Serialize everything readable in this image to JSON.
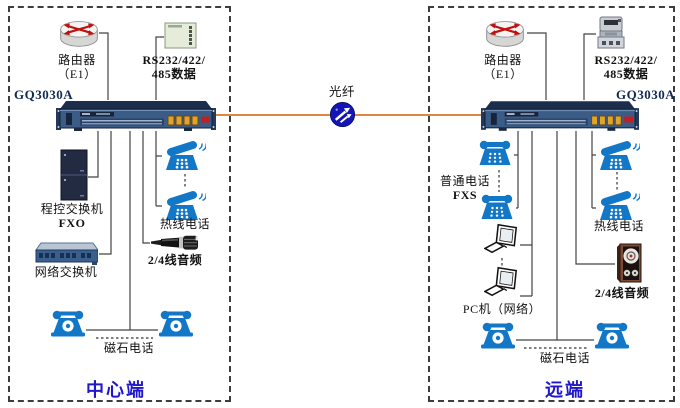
{
  "fiber": {
    "label": "光纤"
  },
  "left_site": {
    "title": "中心端",
    "terminal_label": "GQ3030A",
    "router": {
      "line1": "路由器",
      "line2": "（E1）"
    },
    "serial_data": {
      "line1": "RS232/422/",
      "line2": "485数据"
    },
    "pbx": {
      "line1": "程控交换机",
      "line2": "FXO"
    },
    "lan_switch": {
      "label": "网络交换机"
    },
    "hotline": {
      "label": "热线电话"
    },
    "audio": {
      "label": "2/4线音频"
    },
    "magneto": {
      "label": "磁石电话"
    }
  },
  "right_site": {
    "title": "远端",
    "terminal_label": "GQ3030A",
    "router": {
      "line1": "路由器",
      "line2": "（E1）"
    },
    "serial_data": {
      "line1": "RS232/422/",
      "line2": "485数据"
    },
    "plain_phone": {
      "line1": "普通电话",
      "line2": "FXS"
    },
    "pc": {
      "label": "PC机（网络）"
    },
    "hotline": {
      "label": "热线电话"
    },
    "audio": {
      "label": "2/4线音频"
    },
    "magneto": {
      "label": "磁石电话"
    }
  },
  "icons": {
    "router": "router-icon",
    "serial_device": "serial-data-device-icon",
    "meter": "serial-data-meter-icon",
    "multiplexer": "gq3030a-chassis-icon",
    "pbx": "pbx-cabinet-icon",
    "lan_switch": "ethernet-switch-icon",
    "hotline_phone": "hotline-phone-icon",
    "desk_phone": "desk-phone-icon",
    "magneto_phone": "magneto-phone-icon",
    "microphone": "microphone-icon",
    "speaker": "speaker-icon",
    "pc": "pc-icon",
    "fiber_globe": "fiber-globe-icon"
  },
  "colors": {
    "phone_blue": "#1377c8",
    "fiber_orange": "#e0873f",
    "site_title_blue": "#2017cc",
    "chassis_navy": "#3c5c88",
    "wire": "#444444"
  }
}
